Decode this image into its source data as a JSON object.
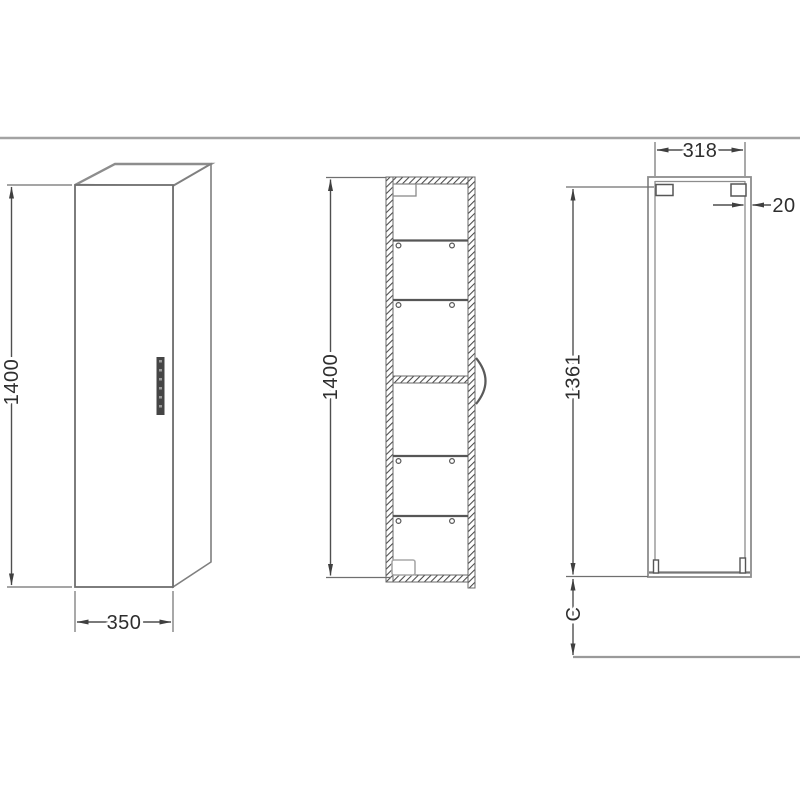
{
  "drawing": {
    "kind": "technical-dimension-drawing",
    "subject": "tall-cabinet-three-views",
    "colors": {
      "background": "#ffffff",
      "object_line": "#7f7f7f",
      "dimension_line": "#4f4f4f",
      "text": "#2e2e2e",
      "handle_fill": "#454545",
      "separator_line": "#a3a3a3"
    },
    "views": {
      "perspective": {
        "label": "front-perspective-view",
        "height_dim": "1400",
        "width_dim": "350"
      },
      "section": {
        "label": "side-section-view",
        "height_dim": "1400",
        "shelf_count": 4
      },
      "rear": {
        "label": "rear-elevation-view",
        "inner_width_dim": "318",
        "wall_thickness_dim": "20",
        "hanging_height_dim": "1361",
        "floor_offset_dim": "C"
      }
    }
  }
}
